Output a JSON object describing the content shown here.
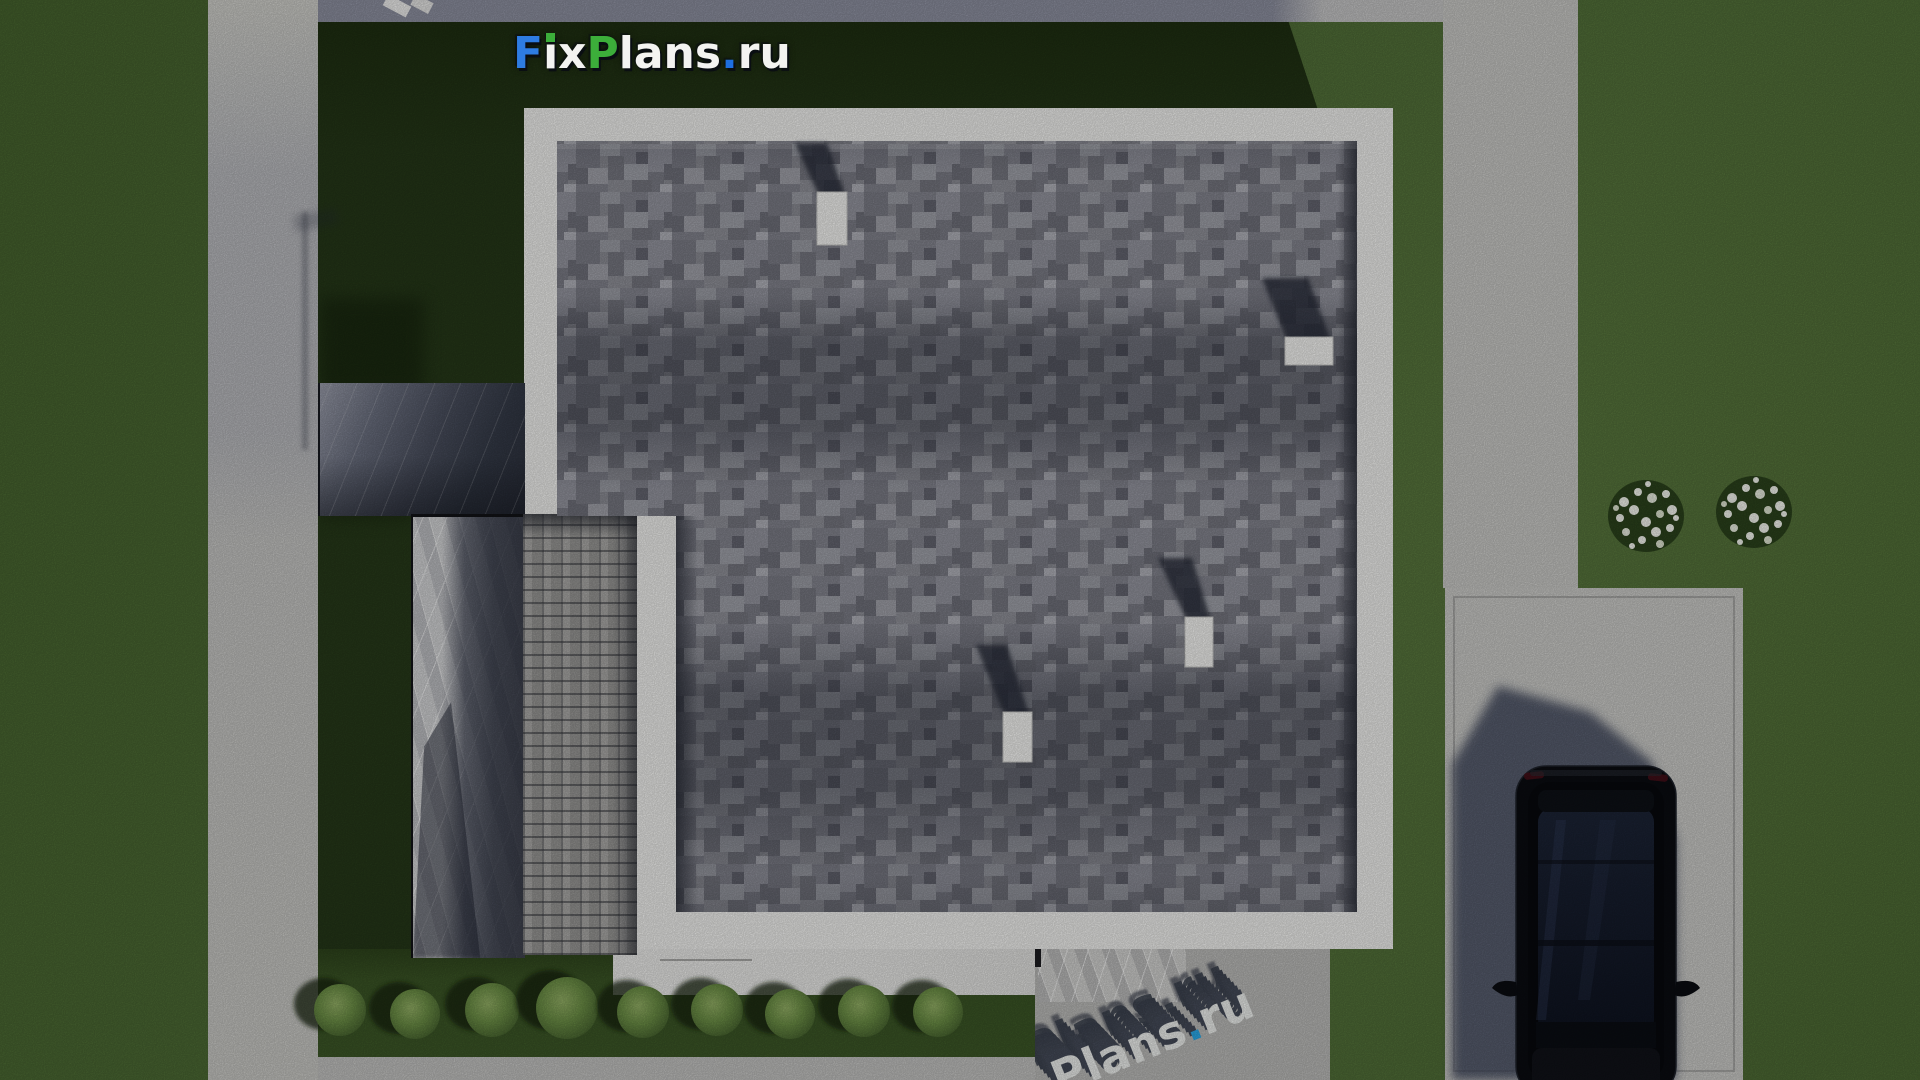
{
  "watermark_top": {
    "full_text": "FixPlans.ru",
    "f": "F",
    "ix": "ix",
    "p": "P",
    "lans": "lans",
    "dot": ".",
    "ru": "ru",
    "blue": "#2e7ce2",
    "green": "#3cae3a",
    "white": "#f3f3f1",
    "dot_blue": "#1e6fe0",
    "i_dot_green": "#3cae3a"
  },
  "watermark_bottom": {
    "full_text": "Plans.ru",
    "plans": "Plans",
    "dot": ".",
    "ru": "ru",
    "white": "#eef0ee",
    "dot_blue": "#2aa9e8",
    "extrusion": "#454b59"
  },
  "scene": {
    "description": "aerial 3d render of flat-roof house site plan",
    "palette": {
      "grass": "#4e6c36",
      "grass_shadow": "#253718",
      "concrete": "#c6c6c4",
      "concrete_shadowed": "#8d90a0",
      "roof_shingle_base": "#8b8c94",
      "parapet_white": "#f1f1ef",
      "terrace_marble": "#d3d4d6",
      "pergola_canopy": "#4a4f5e",
      "paver_bricks": "#a3a2a0",
      "garden_bed": "#3a5425",
      "bush_foliage": "#6c8f46",
      "flower_white": "#f4f6ef",
      "car_body": "#0a0c11",
      "car_glass": "#1c2436",
      "car_shadow": "#3a4258",
      "vent_white": "#f4f4f2"
    }
  }
}
